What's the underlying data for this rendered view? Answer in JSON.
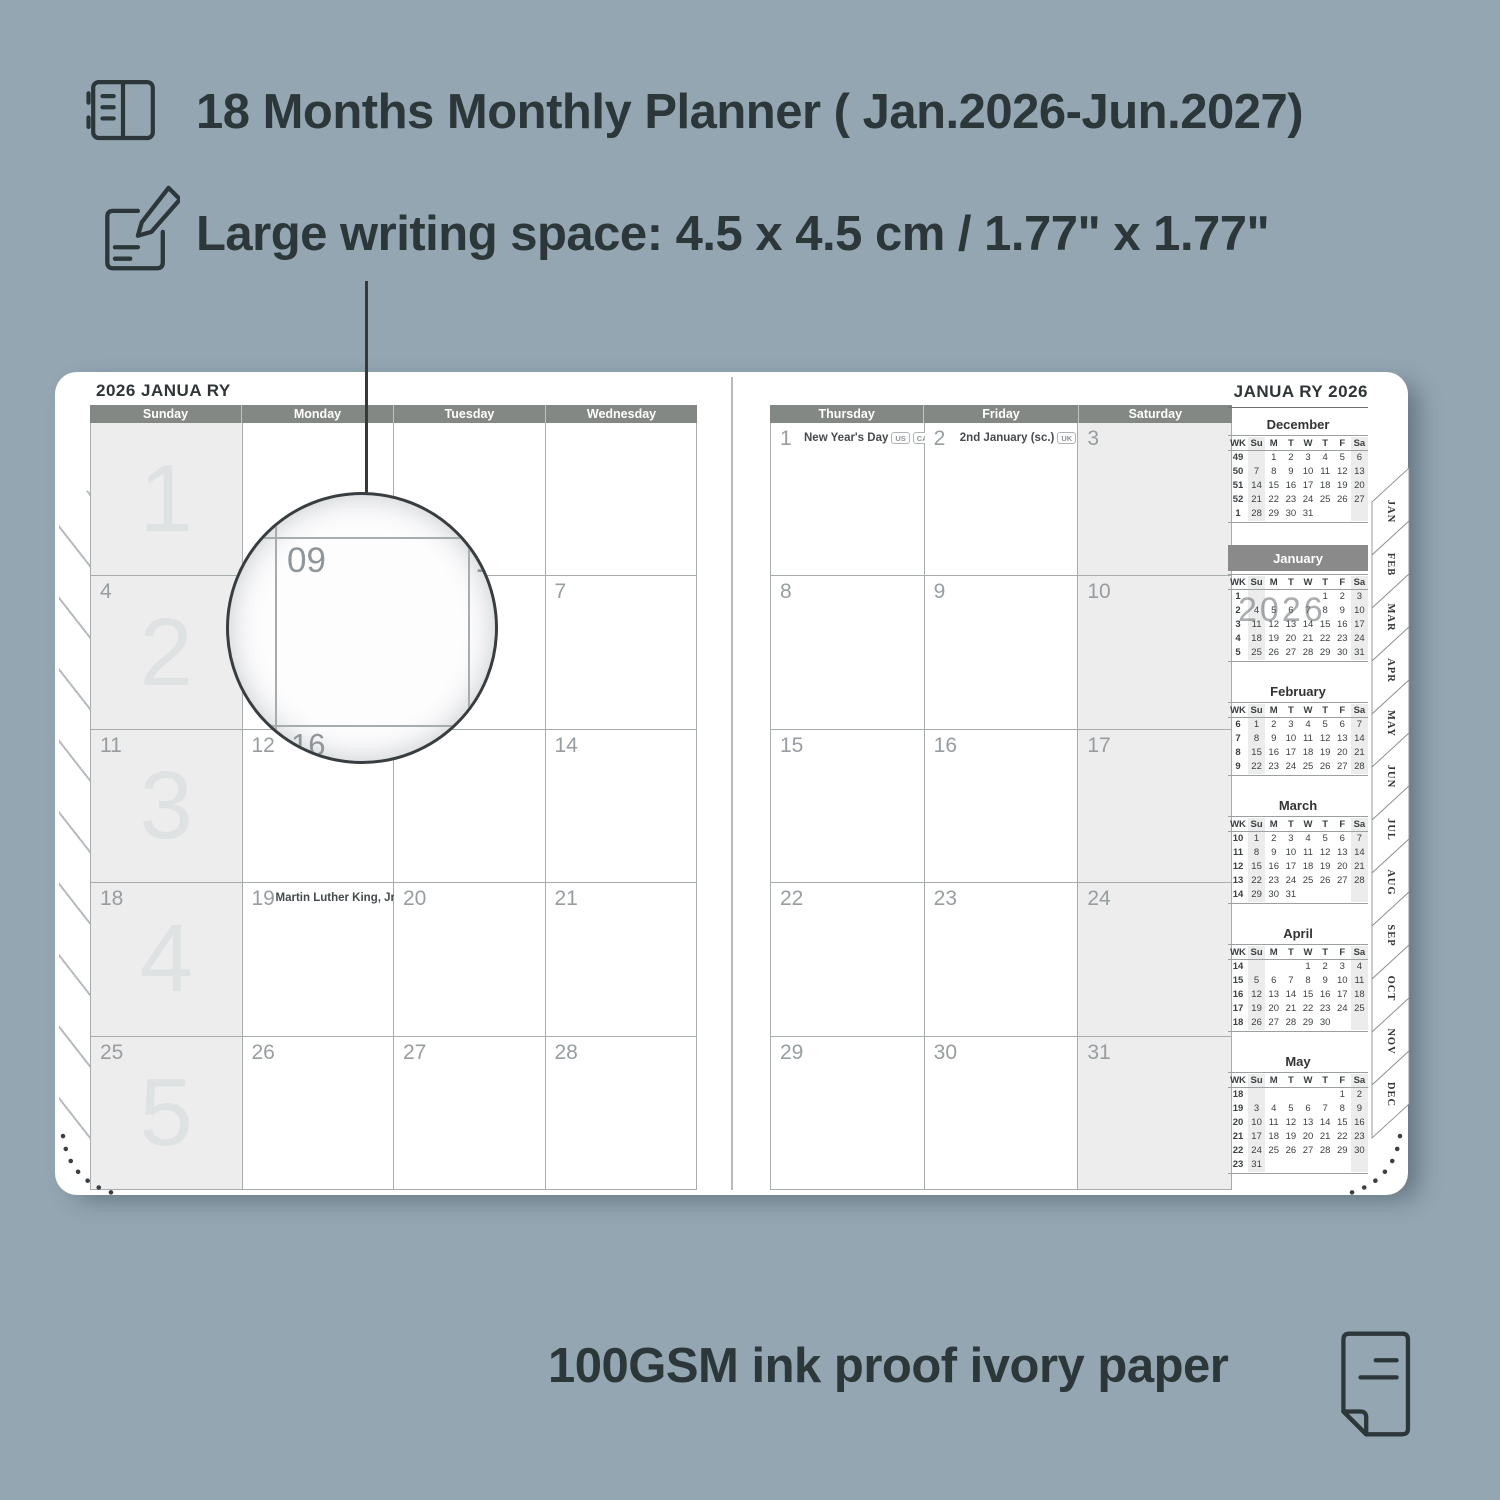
{
  "colors": {
    "background": "#93a6b2",
    "ink": "#2c373a",
    "page": "#ffffff",
    "day_header_bg": "#848884",
    "highlight_month_bg": "#8a8a8a",
    "shaded_column": "#ededee",
    "grid_line": "#a7acae",
    "date_text": "#979da0",
    "week_watermark": "#dfe2e3"
  },
  "features": [
    {
      "icon": "planner-book-icon",
      "text": "18 Months Monthly Planner ( Jan.2026-Jun.2027)"
    },
    {
      "icon": "pencil-note-icon",
      "text": "Large writing space: 4.5 x 4.5 cm / 1.77\" x 1.77\""
    }
  ],
  "footer": {
    "icon": "paper-sheet-icon",
    "text": "100GSM ink proof ivory paper"
  },
  "left_page": {
    "title": "2026 JANUA RY",
    "day_headers": [
      "Sunday",
      "Monday",
      "Tuesday",
      "Wednesday"
    ],
    "shaded_column": 0,
    "weeks": [
      {
        "watermark": "1",
        "cells": [
          {
            "date": ""
          },
          {
            "date": ""
          },
          {
            "date": ""
          },
          {
            "date": ""
          }
        ]
      },
      {
        "watermark": "2",
        "cells": [
          {
            "date": "4"
          },
          {
            "date": ""
          },
          {
            "date": ""
          },
          {
            "date": "7"
          }
        ]
      },
      {
        "watermark": "3",
        "cells": [
          {
            "date": "11"
          },
          {
            "date": "12"
          },
          {
            "date": ""
          },
          {
            "date": "14"
          }
        ]
      },
      {
        "watermark": "4",
        "cells": [
          {
            "date": "18"
          },
          {
            "date": "19",
            "holiday": "Martin Luther King, Jr. Day",
            "badges": [
              "US"
            ]
          },
          {
            "date": "20"
          },
          {
            "date": "21"
          }
        ]
      },
      {
        "watermark": "5",
        "cells": [
          {
            "date": "25"
          },
          {
            "date": "26"
          },
          {
            "date": "27"
          },
          {
            "date": "28"
          }
        ]
      }
    ]
  },
  "right_page": {
    "day_headers": [
      "Thursday",
      "Friday",
      "Saturday"
    ],
    "shaded_column": 2,
    "weeks": [
      {
        "cells": [
          {
            "date": "1",
            "holiday": "New Year's Day",
            "badges": [
              "US",
              "CA",
              "UK",
              "IE"
            ]
          },
          {
            "date": "2",
            "holiday": "2nd January (sc.)",
            "badges": [
              "UK"
            ],
            "align": "center"
          },
          {
            "date": "3"
          }
        ]
      },
      {
        "cells": [
          {
            "date": "8"
          },
          {
            "date": "9"
          },
          {
            "date": "10"
          }
        ]
      },
      {
        "cells": [
          {
            "date": "15"
          },
          {
            "date": "16"
          },
          {
            "date": "17"
          }
        ]
      },
      {
        "cells": [
          {
            "date": "22"
          },
          {
            "date": "23"
          },
          {
            "date": "24"
          }
        ]
      },
      {
        "cells": [
          {
            "date": "29"
          },
          {
            "date": "30"
          },
          {
            "date": "31"
          }
        ]
      }
    ]
  },
  "sidebar": {
    "title": "JANUA RY 2026",
    "weekday_header": [
      "WK",
      "Su",
      "M",
      "T",
      "W",
      "T",
      "F",
      "Sa"
    ],
    "mini_calendars": [
      {
        "name": "December",
        "rows": [
          [
            "49",
            "",
            "1",
            "2",
            "3",
            "4",
            "5",
            "6"
          ],
          [
            "50",
            "7",
            "8",
            "9",
            "10",
            "11",
            "12",
            "13"
          ],
          [
            "51",
            "14",
            "15",
            "16",
            "17",
            "18",
            "19",
            "20"
          ],
          [
            "52",
            "21",
            "22",
            "23",
            "24",
            "25",
            "26",
            "27"
          ],
          [
            "1",
            "28",
            "29",
            "30",
            "31",
            "",
            "",
            ""
          ]
        ]
      },
      {
        "name": "January",
        "highlight": true,
        "watermark": "2026",
        "rows": [
          [
            "1",
            "",
            "",
            "",
            "",
            "1",
            "2",
            "3"
          ],
          [
            "2",
            "4",
            "5",
            "6",
            "7",
            "8",
            "9",
            "10"
          ],
          [
            "3",
            "11",
            "12",
            "13",
            "14",
            "15",
            "16",
            "17"
          ],
          [
            "4",
            "18",
            "19",
            "20",
            "21",
            "22",
            "23",
            "24"
          ],
          [
            "5",
            "25",
            "26",
            "27",
            "28",
            "29",
            "30",
            "31"
          ]
        ]
      },
      {
        "name": "February",
        "rows": [
          [
            "6",
            "1",
            "2",
            "3",
            "4",
            "5",
            "6",
            "7"
          ],
          [
            "7",
            "8",
            "9",
            "10",
            "11",
            "12",
            "13",
            "14"
          ],
          [
            "8",
            "15",
            "16",
            "17",
            "18",
            "19",
            "20",
            "21"
          ],
          [
            "9",
            "22",
            "23",
            "24",
            "25",
            "26",
            "27",
            "28"
          ]
        ]
      },
      {
        "name": "March",
        "rows": [
          [
            "10",
            "1",
            "2",
            "3",
            "4",
            "5",
            "6",
            "7"
          ],
          [
            "11",
            "8",
            "9",
            "10",
            "11",
            "12",
            "13",
            "14"
          ],
          [
            "12",
            "15",
            "16",
            "17",
            "18",
            "19",
            "20",
            "21"
          ],
          [
            "13",
            "22",
            "23",
            "24",
            "25",
            "26",
            "27",
            "28"
          ],
          [
            "14",
            "29",
            "30",
            "31",
            "",
            "",
            "",
            ""
          ]
        ]
      },
      {
        "name": "April",
        "rows": [
          [
            "14",
            "",
            "",
            "",
            "1",
            "2",
            "3",
            "4"
          ],
          [
            "15",
            "5",
            "6",
            "7",
            "8",
            "9",
            "10",
            "11"
          ],
          [
            "16",
            "12",
            "13",
            "14",
            "15",
            "16",
            "17",
            "18"
          ],
          [
            "17",
            "19",
            "20",
            "21",
            "22",
            "23",
            "24",
            "25"
          ],
          [
            "18",
            "26",
            "27",
            "28",
            "29",
            "30",
            "",
            ""
          ]
        ]
      },
      {
        "name": "May",
        "rows": [
          [
            "18",
            "",
            "",
            "",
            "",
            "",
            "1",
            "2"
          ],
          [
            "19",
            "3",
            "4",
            "5",
            "6",
            "7",
            "8",
            "9"
          ],
          [
            "20",
            "10",
            "11",
            "12",
            "13",
            "14",
            "15",
            "16"
          ],
          [
            "21",
            "17",
            "18",
            "19",
            "20",
            "21",
            "22",
            "23"
          ],
          [
            "22",
            "24",
            "25",
            "26",
            "27",
            "28",
            "29",
            "30"
          ],
          [
            "23",
            "31",
            "",
            "",
            "",
            "",
            "",
            ""
          ]
        ]
      }
    ]
  },
  "tabs": [
    "JAN",
    "FEB",
    "MAR",
    "APR",
    "MAY",
    "JUN",
    "JUL",
    "AUG",
    "SEP",
    "OCT",
    "NOV",
    "DEC"
  ],
  "magnifier": {
    "cell_date": "09",
    "right_date": "10",
    "below_date": "16"
  }
}
